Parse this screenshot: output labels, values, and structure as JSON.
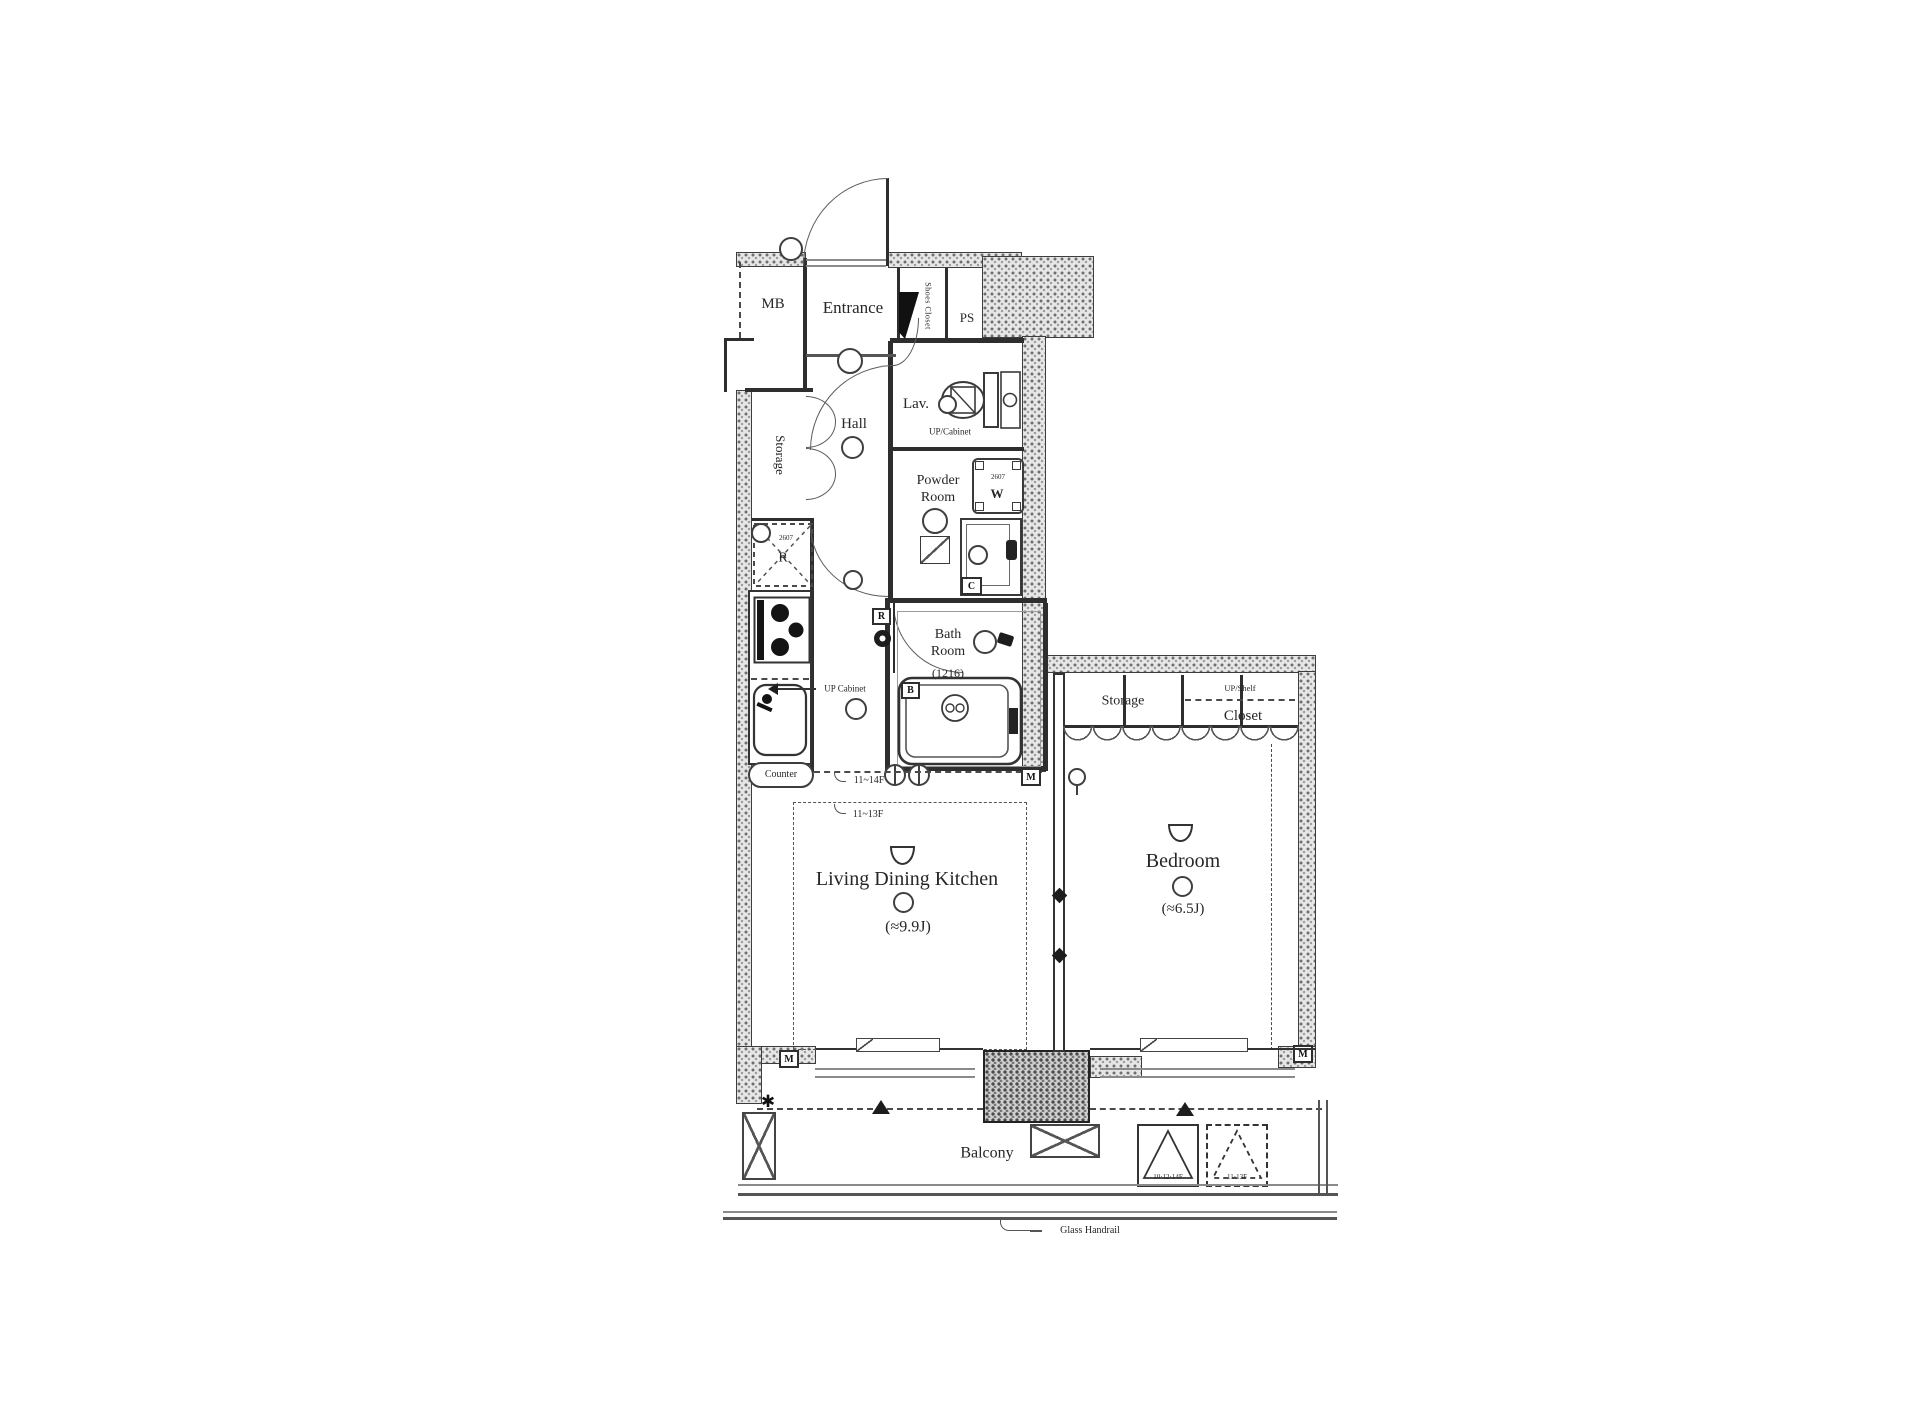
{
  "rooms": {
    "mb": "MB",
    "entrance": "Entrance",
    "ps": "PS",
    "shoes_closet": "Shoes Closet",
    "lav": "Lav.",
    "hall": "Hall",
    "storage_hall": "Storage",
    "powder_room": "Powder\nRoom",
    "bath_room": "Bath\nRoom",
    "bath_room_size": "(1216)",
    "ldk": "Living Dining Kitchen",
    "ldk_size": "(≈9.9J)",
    "bedroom": "Bedroom",
    "bedroom_size": "(≈6.5J)",
    "bedroom_storage": "Storage",
    "closet": "Closet",
    "balcony": "Balcony"
  },
  "annotations": {
    "up_cabinet_lav": "UP/Cabinet",
    "up_cabinet_kitchen": "UP Cabinet",
    "up_shelf": "UP/Shelf",
    "counter": "Counter",
    "floors_upper": "11~14F",
    "floors_lower": "11~13F",
    "glass_handrail": "Glass Handrail",
    "hatch_solid_floors": "10·12·14F",
    "hatch_dashed_floors": "11·13F",
    "washer_dim": "2607",
    "fridge_dim": "2607"
  },
  "markers": {
    "m": "M",
    "b": "B",
    "c": "C",
    "r": "R",
    "w": "W",
    "fridge": "R"
  },
  "colors": {
    "line": "#3a3a3a",
    "wall_fill": "#e6e6e6",
    "text": "#262626"
  }
}
